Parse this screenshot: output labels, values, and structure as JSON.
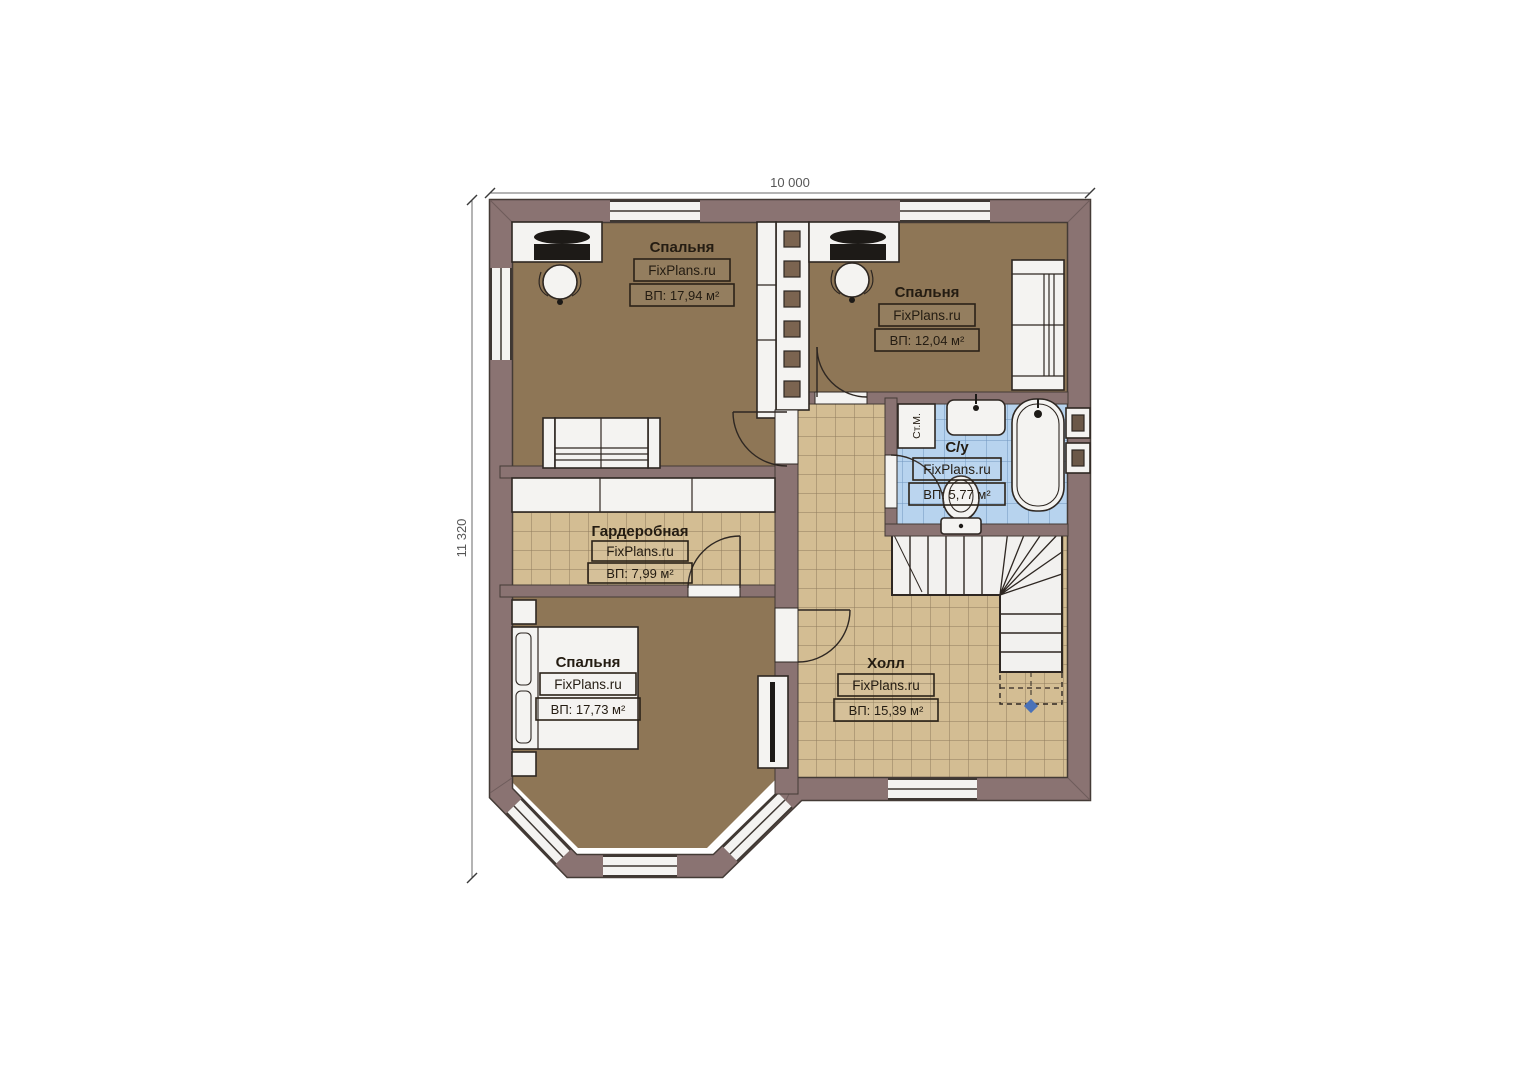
{
  "plan": {
    "brand_label": "FixPlans.ru",
    "dimensions": {
      "width": "10 000",
      "height": "11 320"
    },
    "rooms": [
      {
        "id": "bedroom-top-left",
        "name": "Спальня",
        "area": "ВП: 17,94 м²"
      },
      {
        "id": "bedroom-top-right",
        "name": "Спальня",
        "area": "ВП: 12,04 м²"
      },
      {
        "id": "bathroom",
        "name": "С/у",
        "area": "ВП: 5,77 м²"
      },
      {
        "id": "wardrobe",
        "name": "Гардеробная",
        "area": "ВП: 7,99 м²"
      },
      {
        "id": "bedroom-bottom-left",
        "name": "Спальня",
        "area": "ВП: 17,73 м²"
      },
      {
        "id": "hall",
        "name": "Холл",
        "area": "ВП: 15,39 м²"
      }
    ],
    "annotations": {
      "washing_machine": "Ст.М."
    },
    "colors": {
      "wall": "#8a7372",
      "bedroom_floor": "#8e7656",
      "tile_floor": "#d3bd93",
      "bathroom_floor": "#b7d3ee",
      "fixture_white": "#f4f3f1",
      "outline": "#2e2722"
    }
  }
}
